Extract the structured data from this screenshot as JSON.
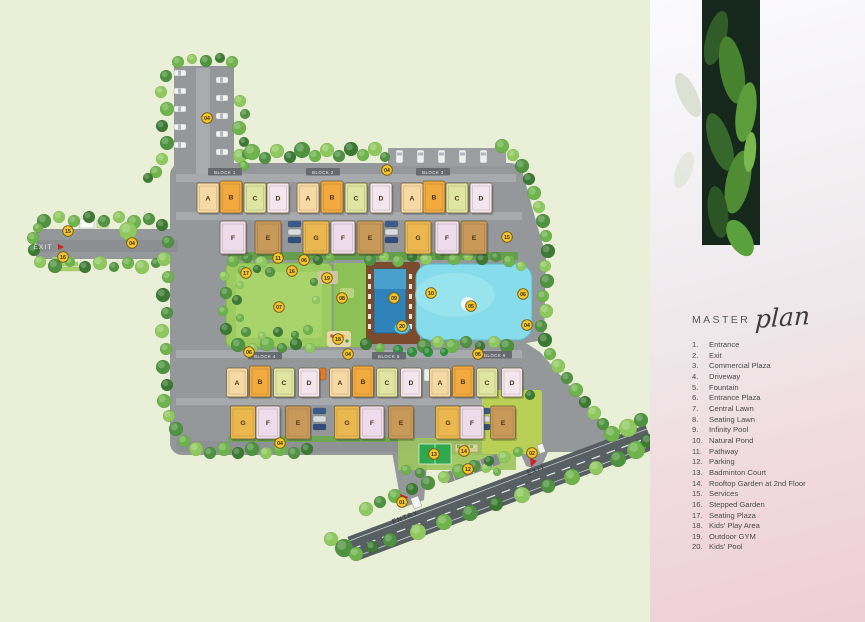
{
  "panel": {
    "title_master": "MASTER",
    "title_plan": "plan",
    "legend": [
      {
        "n": "1.",
        "label": "Entrance"
      },
      {
        "n": "2.",
        "label": "Exit"
      },
      {
        "n": "3.",
        "label": "Commercial Plaza"
      },
      {
        "n": "4.",
        "label": "Driveway"
      },
      {
        "n": "5.",
        "label": "Fountain"
      },
      {
        "n": "6.",
        "label": "Entrance Plaza"
      },
      {
        "n": "7.",
        "label": "Central Lawn"
      },
      {
        "n": "8.",
        "label": "Seating Lawn"
      },
      {
        "n": "9.",
        "label": "Infinity Pool"
      },
      {
        "n": "10.",
        "label": "Natural Pond"
      },
      {
        "n": "11.",
        "label": "Pathway"
      },
      {
        "n": "12.",
        "label": "Parking"
      },
      {
        "n": "13.",
        "label": "Badminton Court"
      },
      {
        "n": "14.",
        "label": "Rooftop Garden at 2nd Floor"
      },
      {
        "n": "15.",
        "label": "Services"
      },
      {
        "n": "16.",
        "label": "Stepped Garden"
      },
      {
        "n": "17.",
        "label": "Seating Plaza"
      },
      {
        "n": "18.",
        "label": "Kids' Play Area"
      },
      {
        "n": "19.",
        "label": "Outdoor GYM"
      },
      {
        "n": "20.",
        "label": "Kids' Pool"
      }
    ]
  },
  "plan": {
    "colors": {
      "background": "#eaf0d8",
      "road": "#94989a",
      "marker_fill": "#f3c52f",
      "marker_border": "#7a5a10",
      "pond": "#86dcea",
      "infinity_pool": "#2f83b8",
      "lawn": "#9ccb60",
      "deck": "#7c4b2d",
      "building_A": "#f6d9a4",
      "building_B": "#f2a93e",
      "building_C": "#dfe6a2",
      "building_D": "#f3e6ee",
      "building_E": "#c9995a",
      "building_F": "#eedcec",
      "building_G": "#eab84e"
    },
    "blocks": [
      {
        "label": "BLOCK 1",
        "x": 225,
        "y": 172
      },
      {
        "label": "BLOCK 2",
        "x": 323,
        "y": 172
      },
      {
        "label": "BLOCK 3",
        "x": 433,
        "y": 172
      },
      {
        "label": "BLOCK 4",
        "x": 265,
        "y": 356
      },
      {
        "label": "BLOCK 5",
        "x": 389,
        "y": 356
      },
      {
        "label": "BLOCK 6",
        "x": 495,
        "y": 355
      }
    ],
    "buildings": [
      {
        "letter": "A",
        "x": 208,
        "y": 183,
        "w": 22,
        "h": 30
      },
      {
        "letter": "B",
        "x": 231,
        "y": 181,
        "w": 22,
        "h": 32
      },
      {
        "letter": "C",
        "x": 255,
        "y": 183,
        "w": 22,
        "h": 30
      },
      {
        "letter": "D",
        "x": 278,
        "y": 183,
        "w": 22,
        "h": 30
      },
      {
        "letter": "A",
        "x": 308,
        "y": 183,
        "w": 22,
        "h": 30
      },
      {
        "letter": "B",
        "x": 332,
        "y": 181,
        "w": 22,
        "h": 32
      },
      {
        "letter": "C",
        "x": 356,
        "y": 183,
        "w": 22,
        "h": 30
      },
      {
        "letter": "D",
        "x": 381,
        "y": 183,
        "w": 22,
        "h": 30
      },
      {
        "letter": "A",
        "x": 412,
        "y": 183,
        "w": 22,
        "h": 30
      },
      {
        "letter": "B",
        "x": 434,
        "y": 181,
        "w": 22,
        "h": 32
      },
      {
        "letter": "C",
        "x": 457,
        "y": 183,
        "w": 22,
        "h": 30
      },
      {
        "letter": "D",
        "x": 481,
        "y": 183,
        "w": 22,
        "h": 30
      },
      {
        "letter": "F",
        "x": 233,
        "y": 221,
        "w": 26,
        "h": 33
      },
      {
        "letter": "E",
        "x": 268,
        "y": 221,
        "w": 26,
        "h": 33
      },
      {
        "letter": "G",
        "x": 316,
        "y": 221,
        "w": 26,
        "h": 33
      },
      {
        "letter": "F",
        "x": 343,
        "y": 221,
        "w": 24,
        "h": 33
      },
      {
        "letter": "E",
        "x": 370,
        "y": 221,
        "w": 26,
        "h": 33
      },
      {
        "letter": "G",
        "x": 418,
        "y": 221,
        "w": 26,
        "h": 33
      },
      {
        "letter": "F",
        "x": 447,
        "y": 221,
        "w": 24,
        "h": 33
      },
      {
        "letter": "E",
        "x": 474,
        "y": 221,
        "w": 26,
        "h": 33
      },
      {
        "letter": "A",
        "x": 237,
        "y": 368,
        "w": 21,
        "h": 29
      },
      {
        "letter": "B",
        "x": 260,
        "y": 366,
        "w": 21,
        "h": 31
      },
      {
        "letter": "C",
        "x": 284,
        "y": 368,
        "w": 21,
        "h": 29
      },
      {
        "letter": "D",
        "x": 309,
        "y": 368,
        "w": 21,
        "h": 29
      },
      {
        "letter": "A",
        "x": 340,
        "y": 368,
        "w": 21,
        "h": 29
      },
      {
        "letter": "B",
        "x": 363,
        "y": 366,
        "w": 21,
        "h": 31
      },
      {
        "letter": "C",
        "x": 387,
        "y": 368,
        "w": 21,
        "h": 29
      },
      {
        "letter": "D",
        "x": 411,
        "y": 368,
        "w": 21,
        "h": 29
      },
      {
        "letter": "A",
        "x": 440,
        "y": 368,
        "w": 21,
        "h": 29
      },
      {
        "letter": "B",
        "x": 463,
        "y": 366,
        "w": 21,
        "h": 31
      },
      {
        "letter": "C",
        "x": 487,
        "y": 368,
        "w": 21,
        "h": 29
      },
      {
        "letter": "D",
        "x": 512,
        "y": 368,
        "w": 21,
        "h": 29
      },
      {
        "letter": "G",
        "x": 243,
        "y": 406,
        "w": 25,
        "h": 33
      },
      {
        "letter": "F",
        "x": 268,
        "y": 406,
        "w": 24,
        "h": 33
      },
      {
        "letter": "E",
        "x": 298,
        "y": 406,
        "w": 25,
        "h": 33
      },
      {
        "letter": "G",
        "x": 347,
        "y": 406,
        "w": 25,
        "h": 33
      },
      {
        "letter": "F",
        "x": 372,
        "y": 406,
        "w": 24,
        "h": 33
      },
      {
        "letter": "E",
        "x": 401,
        "y": 406,
        "w": 25,
        "h": 33
      },
      {
        "letter": "G",
        "x": 448,
        "y": 406,
        "w": 25,
        "h": 33
      },
      {
        "letter": "F",
        "x": 472,
        "y": 406,
        "w": 24,
        "h": 33
      },
      {
        "letter": "E",
        "x": 503,
        "y": 406,
        "w": 25,
        "h": 33
      }
    ],
    "markers": [
      {
        "n": "01",
        "x": 402,
        "y": 502
      },
      {
        "n": "02",
        "x": 532,
        "y": 453
      },
      {
        "n": "04",
        "x": 207,
        "y": 118
      },
      {
        "n": "04",
        "x": 387,
        "y": 170
      },
      {
        "n": "04",
        "x": 132,
        "y": 243
      },
      {
        "n": "04",
        "x": 348,
        "y": 354
      },
      {
        "n": "04",
        "x": 280,
        "y": 443
      },
      {
        "n": "04",
        "x": 527,
        "y": 325
      },
      {
        "n": "05",
        "x": 471,
        "y": 306
      },
      {
        "n": "06",
        "x": 304,
        "y": 260
      },
      {
        "n": "06",
        "x": 249,
        "y": 352
      },
      {
        "n": "06",
        "x": 478,
        "y": 354
      },
      {
        "n": "06",
        "x": 523,
        "y": 294
      },
      {
        "n": "07",
        "x": 279,
        "y": 307
      },
      {
        "n": "08",
        "x": 342,
        "y": 298
      },
      {
        "n": "09",
        "x": 394,
        "y": 298
      },
      {
        "n": "10",
        "x": 431,
        "y": 293
      },
      {
        "n": "11",
        "x": 278,
        "y": 258
      },
      {
        "n": "12",
        "x": 468,
        "y": 469
      },
      {
        "n": "13",
        "x": 434,
        "y": 454
      },
      {
        "n": "14",
        "x": 464,
        "y": 451
      },
      {
        "n": "15",
        "x": 68,
        "y": 231
      },
      {
        "n": "15",
        "x": 507,
        "y": 237
      },
      {
        "n": "16",
        "x": 292,
        "y": 271
      },
      {
        "n": "16",
        "x": 63,
        "y": 257
      },
      {
        "n": "17",
        "x": 246,
        "y": 273
      },
      {
        "n": "18",
        "x": 338,
        "y": 339
      },
      {
        "n": "19",
        "x": 327,
        "y": 278
      },
      {
        "n": "20",
        "x": 402,
        "y": 326
      }
    ],
    "road_labels": [
      {
        "text": "ENTRY",
        "x": 406,
        "y": 519,
        "rot": -20.6,
        "fill": "#2f3335"
      },
      {
        "text": "EXIT",
        "x": 537,
        "y": 472,
        "rot": -20.6,
        "fill": "#2f3335"
      },
      {
        "text": "EXIT",
        "x": 43,
        "y": 249,
        "rot": 0,
        "fill": "#ececec",
        "small": true
      }
    ]
  }
}
